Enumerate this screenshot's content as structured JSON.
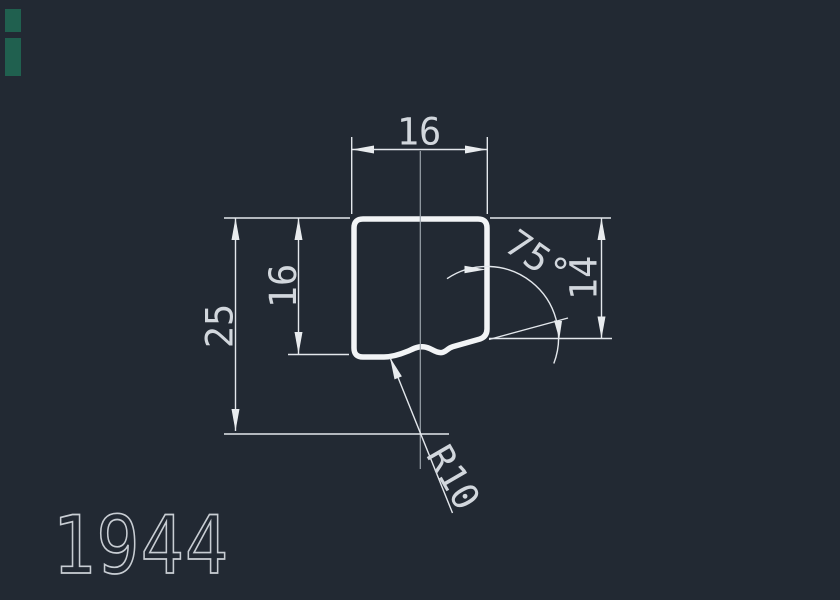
{
  "drawing": {
    "title": "profile-cross-section",
    "dims": {
      "top_width": "16",
      "inner_height": "16",
      "overall_height": "25",
      "right_height": "14",
      "angle": "75°",
      "radius": "R10"
    },
    "part_number": "1944"
  },
  "colors": {
    "background": "#222933",
    "profile_outline": "#f2f4f6",
    "dimension_lines": "#e3e7ec",
    "dimension_text": "#d2d7dd",
    "centerline": "#9aa2ab",
    "part_number_text": "#c8cdd3",
    "corner_marks": "#20604f"
  }
}
